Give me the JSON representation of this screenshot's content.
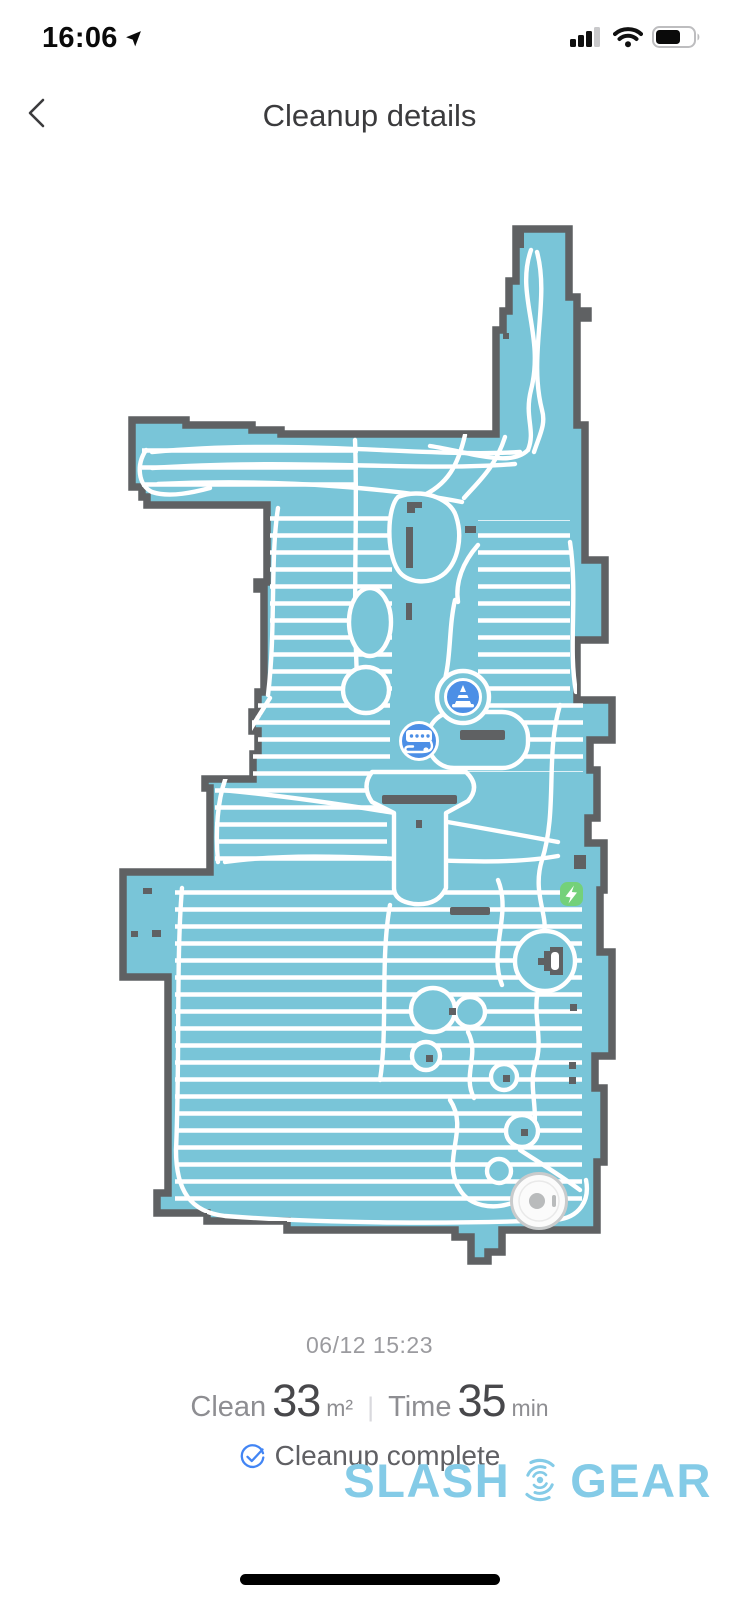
{
  "status_bar": {
    "time": "16:06"
  },
  "header": {
    "title": "Cleanup details"
  },
  "map": {
    "markers": {
      "cone": "obstacle-cone-marker",
      "power_strip": "power-strip-marker",
      "charging": "charging-flash-marker",
      "dock": "charging-dock",
      "robot": "robot-vacuum"
    }
  },
  "stats": {
    "date": "06/12 15:23",
    "clean_label": "Clean",
    "clean_value": "33",
    "clean_unit": "m²",
    "divider": "|",
    "time_label": "Time",
    "time_value": "35",
    "time_unit": "min",
    "status": "Cleanup complete"
  },
  "watermark": {
    "part1": "SLASH",
    "part2": "GEAR"
  },
  "colors": {
    "map_fill": "#79c5d8",
    "map_border": "#5f6163",
    "path_white": "#ffffff",
    "marker_blue": "#4c8fe6",
    "charge_green": "#74d17a",
    "check_blue": "#4285f4",
    "logo_blue": "#84cbe7"
  }
}
